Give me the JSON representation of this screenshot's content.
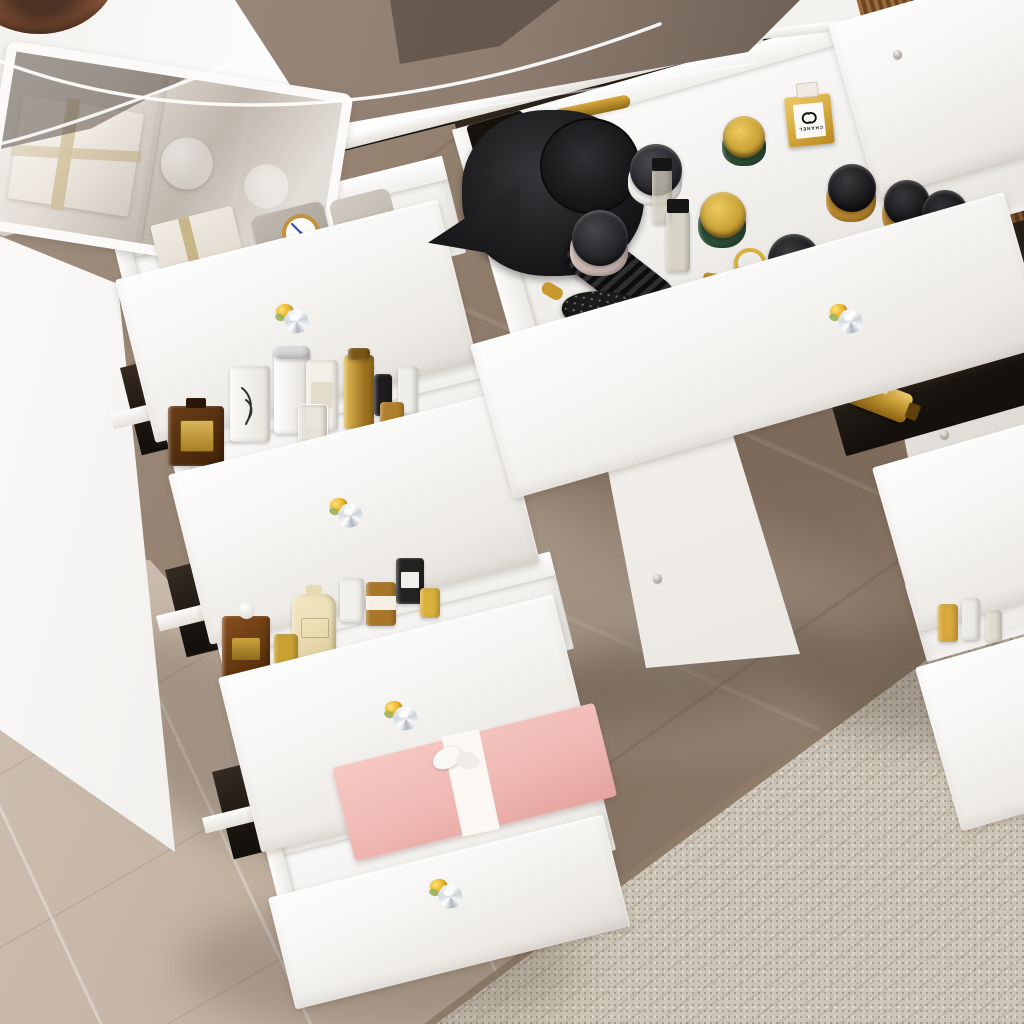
{
  "meta": {
    "title": "White vanity dressing table with open cosmetic drawers",
    "view": "three-quarter overhead product photo"
  },
  "labels": {
    "perfume_brand": "CHANEL",
    "jar_brand": "LCRAC"
  },
  "colors": {
    "furniture-white": "#f7f6f4",
    "furniture-shadow": "#dfdbd5",
    "interior-white": "#f1efec",
    "glass-taupe": "#8f7d70",
    "glass-dark": "#5f544b",
    "floor-marble-dark": "#8d7a6a",
    "floor-marble-light": "#c8b9aa",
    "carpet-beige": "#cdc5b7",
    "carpet-seam": "#8f7e6a",
    "knob-gold": "#e8b527",
    "knob-crystal": "#dfe5e8",
    "hairdryer-black": "#1a1a1c",
    "jar-green": "#2c4e36",
    "lid-gold": "#c9a136",
    "jar-amber": "#b9862e",
    "lid-black": "#1f1f22",
    "chanel-gold": "#d8ae45",
    "giftbox-pink": "#f0b9b4",
    "ribbon-white": "#faf8f4",
    "ribbon-tan": "#c8b68b",
    "watch-gold": "#c2923f",
    "clock-hands": "#3454b4",
    "lotion-cream": "#ecdfb5",
    "flacon-amber": "#6b3e1a",
    "cable-white": "#fcfcfb",
    "copper": "#8a5338",
    "slat-brown": "#8a5a32"
  },
  "scene": {
    "floor": {
      "left": "light beige marble",
      "center": "taupe marble with veins",
      "bottom_right": "beige woven carpet"
    },
    "furniture": {
      "material": "white lacquered wood",
      "top": "tempered glass with see-through display compartment",
      "knobs": "crystal knobs with gold base",
      "visible_knob_count": 5
    },
    "drawers": {
      "left_column": [
        {
          "position": 1,
          "contents": [
            "white gift box with tan ribbon",
            "divider",
            "gray watch pillow",
            "gold-rim watch with white face and blue hands",
            "second pillow"
          ]
        },
        {
          "position": 2,
          "contents": [
            "dark amber flacon with gold label",
            "white cylinder bottle",
            "silver-cap white bottle",
            "white labeled bottle",
            "gold cylinder bottle",
            "small black bottle",
            "clear jar",
            "small amber bottle",
            "small white bottle"
          ]
        },
        {
          "position": 3,
          "contents": [
            "amber perfume bottle with white sphere stopper",
            "gold mini bottle",
            "cream lotion bottle",
            "white cylinder bottle",
            "amber jar with white label",
            "black jar",
            "small gold bottle"
          ]
        },
        {
          "position": 4,
          "contents": [
            "pink gift box with white ribbon and bow"
          ]
        }
      ],
      "center": {
        "contents": [
          "black hair dryer",
          "round black hairbrush with gold handle tip",
          "mauve jar with black lid",
          "white jar with black lid and printed label",
          "green jar with gold lid (small)",
          "green jar with gold lid (large)",
          "gold CHANEL perfume bottle with white label",
          "two small clear bottles with black caps",
          "amber LCRAC jars with black lids",
          "black-capped amber jars",
          "gold ring",
          "flat amber bottle"
        ]
      },
      "right_column": [
        {
          "position": "top",
          "contents": [
            "white bottle",
            "amber bottle",
            "white bottle"
          ]
        },
        {
          "position": "middle",
          "contents": [
            "lying gold perfume bottle",
            "amber bottles"
          ]
        },
        {
          "position": "bottom",
          "contents": [
            "small gold bottle",
            "small white bottle",
            "small clear bottle"
          ]
        }
      ]
    },
    "accents": [
      "white earphone cable draped on glass top",
      "copper dish at top-left corner",
      "brown slatted organizer at top-right"
    ]
  }
}
